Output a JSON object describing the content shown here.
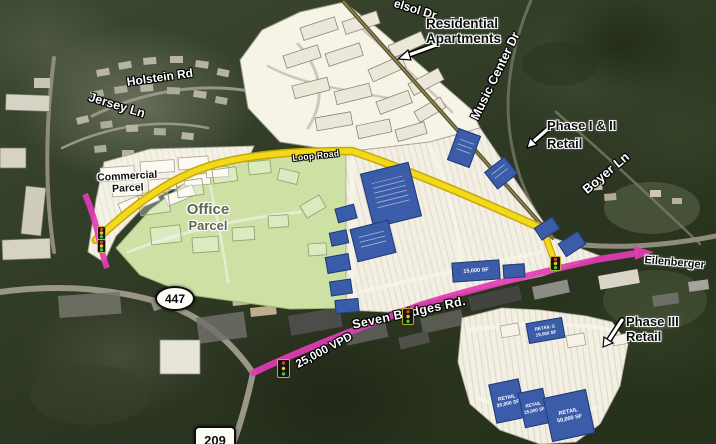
{
  "road_labels": {
    "top_drive": "elsol Dr",
    "music_center": "Music Center Dr",
    "holstein": "Holstein Rd",
    "jersey": "Jersey Ln",
    "loop": "Loop Road",
    "boyer": "Boyer Ln",
    "seven_bridges": "Seven Bridges Rd.",
    "eilenberger": "Eilenberger"
  },
  "traffic": {
    "volume_label": "25,000 VPD"
  },
  "route_shields": {
    "route_447": "447",
    "route_209": "209"
  },
  "annotations": {
    "residential_apartments": {
      "line1": "Residential",
      "line2": "Apartments"
    },
    "phase_1_2_retail": {
      "line1": "Phase I & II",
      "line2": "Retail"
    },
    "phase_3_retail": {
      "line1": "Phase III",
      "line2": "Retail"
    },
    "commercial_parcel": {
      "line1": "Commercial",
      "line2": "Parcel"
    },
    "office_parcel": {
      "line1": "Office",
      "line2": "Parcel"
    }
  },
  "buildings": {
    "pad_15000": {
      "sf": "15,000 SF"
    },
    "retail_g": {
      "name": "RETAIL G",
      "sf": "19,000 SF"
    },
    "retail_30": {
      "name": "RETAIL",
      "sf": "30,000 SF"
    },
    "retail_25": {
      "name": "RETAIL",
      "sf": "25,000 SF"
    },
    "retail_50": {
      "name": "RETAIL",
      "sf": "50,000 SF"
    }
  },
  "colors": {
    "loop_road_highlight": "#f2da1a",
    "arterial_highlight": "#e23cb4",
    "office_parcel_fill": "#cde1a4",
    "plan_paper": "#f6f3e7",
    "building_blue": "#3b5ca8"
  }
}
